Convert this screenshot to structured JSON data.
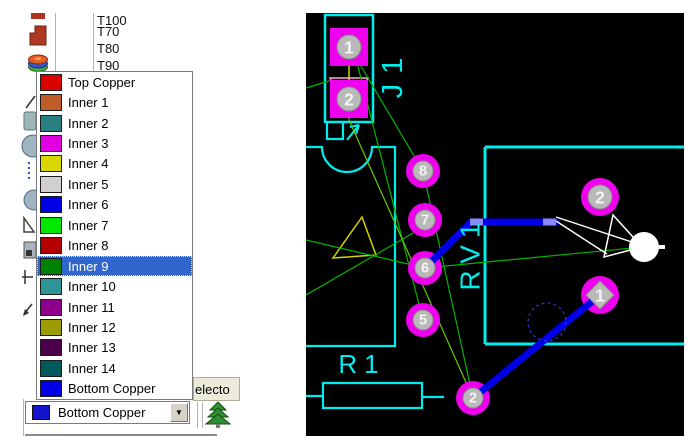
{
  "left_panel": {
    "toolbar": {
      "icons": [
        "toolbar-icon-partial",
        "zone-tool",
        "layer-stack",
        "2d-line-tool",
        "2d-box-tool",
        "2d-circle-tool",
        "2d-path-tool",
        "2d-arc-tool",
        "2d-polygon-tool",
        "component-tool",
        "dimension-tool",
        "marker-tool"
      ]
    },
    "track_list": {
      "items": [
        "T70",
        "T80",
        "T90",
        "T100"
      ]
    },
    "layer_dropdown": {
      "highlight_color": "#3166cc",
      "items": [
        {
          "label": "Top Copper",
          "color": "#dd0000"
        },
        {
          "label": "Inner 1",
          "color": "#c05c28"
        },
        {
          "label": "Inner 2",
          "color": "#2a8080"
        },
        {
          "label": "Inner 3",
          "color": "#e000e0"
        },
        {
          "label": "Inner 4",
          "color": "#d8d800"
        },
        {
          "label": "Inner 5",
          "color": "#d0d0d0"
        },
        {
          "label": "Inner 6",
          "color": "#0000e8"
        },
        {
          "label": "Inner 7",
          "color": "#00e800"
        },
        {
          "label": "Inner 8",
          "color": "#b40000"
        },
        {
          "label": "Inner 9",
          "color": "#008000",
          "selected": true
        },
        {
          "label": "Inner 10",
          "color": "#2f9494"
        },
        {
          "label": "Inner 11",
          "color": "#8c008c"
        },
        {
          "label": "Inner 12",
          "color": "#9c9c00"
        },
        {
          "label": "Inner 13",
          "color": "#4c004c"
        },
        {
          "label": "Inner 14",
          "color": "#005c5c"
        },
        {
          "label": "Bottom Copper",
          "color": "#0000e8"
        }
      ]
    },
    "layer_combo": {
      "value": "Bottom Copper",
      "swatch": "#1414cc",
      "arrow": "▼"
    },
    "selector_tab": {
      "label": "electo"
    }
  },
  "pcb": {
    "view": {
      "x": 306,
      "y": 13,
      "w": 378,
      "h": 423
    },
    "colors": {
      "bg": "#000000",
      "grid": "#3e3e3e",
      "silk": "#00eded",
      "pad": "#ee00ee",
      "pad_inner": "#b9b9b9",
      "pad_inner_edge": "#8a8a8a",
      "ratsnest": "#00b400",
      "ratsnest_hl": "#63cc00",
      "trace": "#0000e6",
      "trace_hl": "#8888ff",
      "white": "#ffffff",
      "yellow": "#d4d400",
      "pink": "#ffaacc",
      "via": "#3333cc",
      "pad_num": "#f4f4f4"
    },
    "outlines": [
      {
        "name": "connector-j1-outline",
        "d": "M 325 15 H 373 V 122 H 325 Z",
        "w": 2.5
      },
      {
        "name": "j1-pin1-bracket",
        "d": "M 327 122 V 139 H 343 V 122",
        "w": 2.2
      },
      {
        "name": "j1-pin1-arrow",
        "d": "M 347 140 L 359 125 M 359 125 L 350 127 M 359 125 L 356 134",
        "w": 2
      },
      {
        "name": "ic-outline",
        "d": "M 306 147 H 322 A 25 25 0 0 0 372 147 H 395 V 346 H 306",
        "w": 2.2
      },
      {
        "name": "big-box-outline",
        "d": "M 485 147 H 684 M 485 147 V 344 M 485 344 H 684",
        "w": 3
      },
      {
        "name": "resistor-r1-outline",
        "d": "M 323 383 H 422 V 408 H 323 Z M 306 396 H 323 M 422 397 H 444",
        "w": 2.2
      }
    ],
    "ratsnest": [
      {
        "x1": 306,
        "y1": 88,
        "x2": 332,
        "y2": 80
      },
      {
        "x1": 349,
        "y1": 46,
        "x2": 423,
        "y2": 171
      },
      {
        "x1": 355,
        "y1": 55,
        "x2": 423,
        "y2": 320
      },
      {
        "x1": 306,
        "y1": 240,
        "x2": 425,
        "y2": 268
      },
      {
        "x1": 306,
        "y1": 295,
        "x2": 427,
        "y2": 225
      },
      {
        "x1": 425,
        "y1": 268,
        "x2": 643,
        "y2": 247
      },
      {
        "x1": 423,
        "y1": 171,
        "x2": 473,
        "y2": 398
      },
      {
        "x1": 349,
        "y1": 120,
        "x2": 473,
        "y2": 398,
        "hl": true
      }
    ],
    "traces": [
      {
        "points": "425,268 471,222 556,222",
        "w": 7
      },
      {
        "points": "600,295 473,398",
        "w": 7
      }
    ],
    "trace_highlights": [
      {
        "points": "470,222 483,222",
        "w": 7
      },
      {
        "points": "543,222 556,222",
        "w": 7
      }
    ],
    "shapes": {
      "yellow_triangle": "362,217 333,258 376,255",
      "pink_triangle": "330,78 368,78 349,118",
      "yellow_line": {
        "x1": 349,
        "y1": 48,
        "x2": 349,
        "y2": 118
      },
      "yellow_arrow": [
        {
          "x1": 349,
          "y1": 118,
          "x2": 343,
          "y2": 109
        },
        {
          "x1": 349,
          "y1": 118,
          "x2": 355,
          "y2": 109
        }
      ],
      "white_lines": [
        {
          "x1": 556,
          "y1": 217,
          "x2": 641,
          "y2": 245
        },
        {
          "x1": 556,
          "y1": 221,
          "x2": 607,
          "y2": 254
        }
      ],
      "white_triangle": "613,215 604,257 642,247",
      "white_circle": {
        "cx": 644,
        "cy": 247,
        "r": 15
      },
      "white_nub": {
        "x1": 659,
        "y1": 247,
        "x2": 665,
        "y2": 247
      },
      "via_circle": {
        "cx": 547,
        "cy": 322,
        "r": 19
      }
    },
    "pads": [
      {
        "shape": "square",
        "cx": 349,
        "cy": 47,
        "size": 38,
        "num": "1",
        "ir": 12
      },
      {
        "shape": "square",
        "cx": 349,
        "cy": 99,
        "size": 38,
        "num": "2",
        "ir": 12
      },
      {
        "shape": "round",
        "cx": 423,
        "cy": 171,
        "r": 17,
        "num": "8",
        "ir": 10
      },
      {
        "shape": "round",
        "cx": 425,
        "cy": 220,
        "r": 17,
        "num": "7",
        "ir": 10
      },
      {
        "shape": "round",
        "cx": 425,
        "cy": 268,
        "r": 17,
        "num": "6",
        "ir": 10
      },
      {
        "shape": "round",
        "cx": 423,
        "cy": 320,
        "r": 17,
        "num": "5",
        "ir": 10
      },
      {
        "shape": "round",
        "cx": 600,
        "cy": 197,
        "r": 19,
        "num": "2",
        "ir": 12
      },
      {
        "shape": "round",
        "cx": 600,
        "cy": 295,
        "r": 19,
        "num": "1",
        "ir": 12,
        "diamond": true
      },
      {
        "shape": "round",
        "cx": 473,
        "cy": 398,
        "r": 17,
        "num": "2",
        "ir": 10
      }
    ],
    "labels": [
      {
        "text": "J1",
        "x": 393,
        "y": 73,
        "rot": -90,
        "size": 29,
        "ls": 10
      },
      {
        "text": "RV1",
        "x": 470,
        "y": 253,
        "rot": -90,
        "size": 28,
        "ls": 7
      },
      {
        "text": "R1",
        "x": 362,
        "y": 364,
        "rot": 0,
        "size": 26,
        "ls": 7
      }
    ]
  }
}
